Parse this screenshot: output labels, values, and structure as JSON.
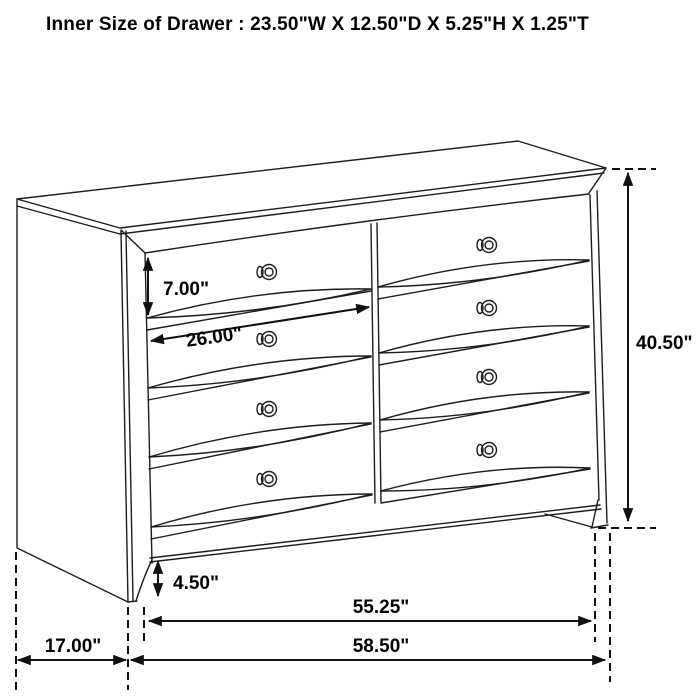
{
  "title": "Inner Size of Drawer : 23.50\"W X 12.50\"D X 5.25\"H X 1.25\"T",
  "diagram": {
    "subject": "dresser-dimension-line-drawing",
    "drawer_rows": 4,
    "drawer_columns": 2,
    "knob_count": 8,
    "colors": {
      "line": "#1c1c1c",
      "background": "#ffffff",
      "text": "#000000"
    },
    "dimensions": {
      "drawer_height": "7.00\"",
      "drawer_width": "26.00\"",
      "overall_height": "40.50\"",
      "base_height": "4.50\"",
      "inner_leg_span": "55.25\"",
      "depth": "17.00\"",
      "overall_width": "58.50\""
    }
  }
}
